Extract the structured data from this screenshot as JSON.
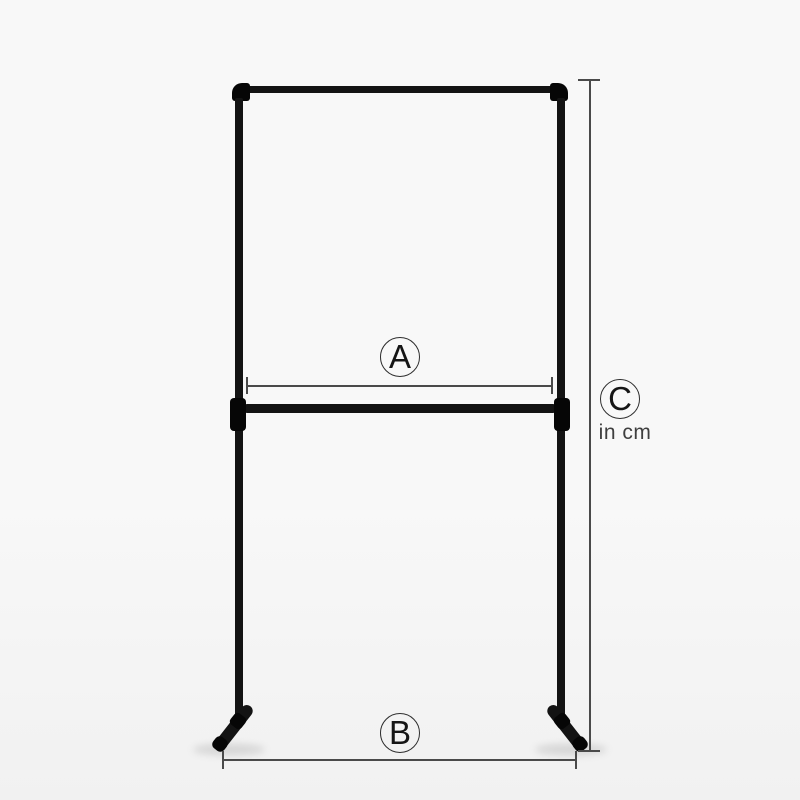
{
  "annotations": {
    "rail_width": {
      "label": "A"
    },
    "base_width": {
      "label": "B"
    },
    "height": {
      "label": "C",
      "unit_note": "in cm"
    }
  },
  "colors": {
    "background_top": "#f8f8f8",
    "background_bottom": "#f1f1f1",
    "pipe": "#131313",
    "pipe_fitting": "#060606",
    "dimension_line": "#4a4a4a",
    "label_circle_stroke": "#2e2e2e",
    "label_text": "#151515",
    "unit_text": "#3f3f3f"
  }
}
